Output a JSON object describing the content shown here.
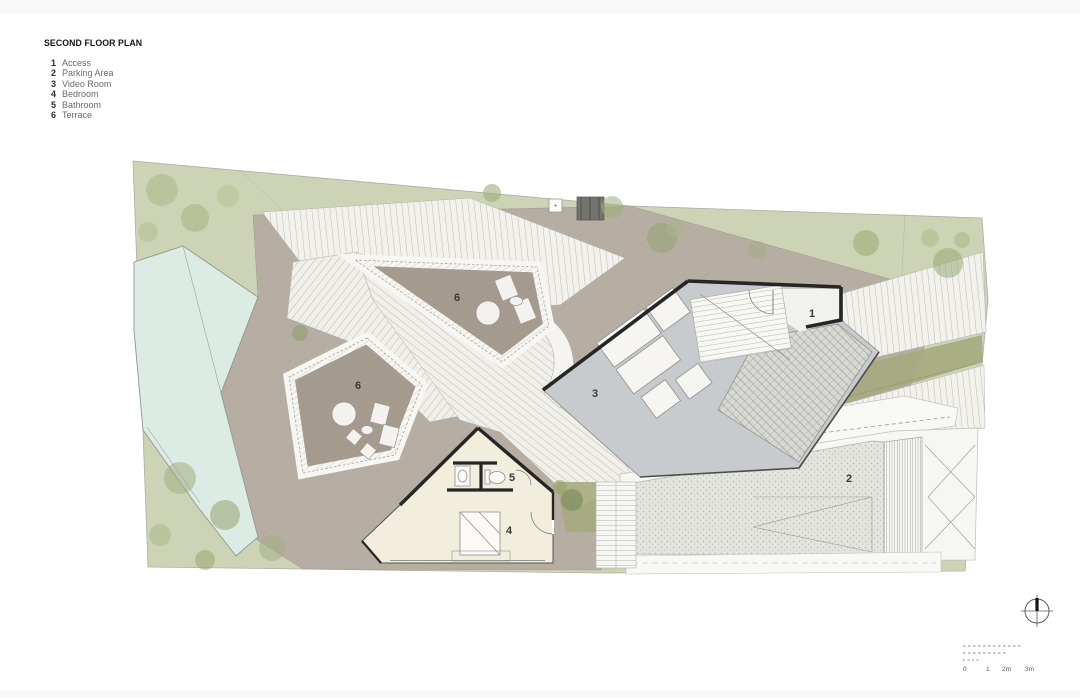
{
  "legend": {
    "title": "SECOND FLOOR PLAN",
    "items": [
      {
        "num": "1",
        "label": "Access"
      },
      {
        "num": "2",
        "label": "Parking Area"
      },
      {
        "num": "3",
        "label": "Video Room"
      },
      {
        "num": "4",
        "label": "Bedroom"
      },
      {
        "num": "5",
        "label": "Bathroom"
      },
      {
        "num": "6",
        "label": "Terrace"
      }
    ]
  },
  "plan": {
    "room_labels": {
      "access": "1",
      "parking": "2",
      "video_room": "3",
      "bedroom": "4",
      "bathroom": "5",
      "terrace_upper": "6",
      "terrace_lower": "6"
    },
    "scale_bar": {
      "m0": "0",
      "m1": "1",
      "m2": "2m",
      "m3": "3m"
    },
    "colors": {
      "lawn": "#cdd4b5",
      "olive": "#a6aa80",
      "deck": "#b6aea3",
      "terrace": "#a59c8f",
      "pool": "#dcebe3",
      "video_room_floor": "#c8cbcd",
      "bedroom_floor": "#f1eedd",
      "parking": "#e4e4df",
      "wall": "#262626"
    }
  }
}
